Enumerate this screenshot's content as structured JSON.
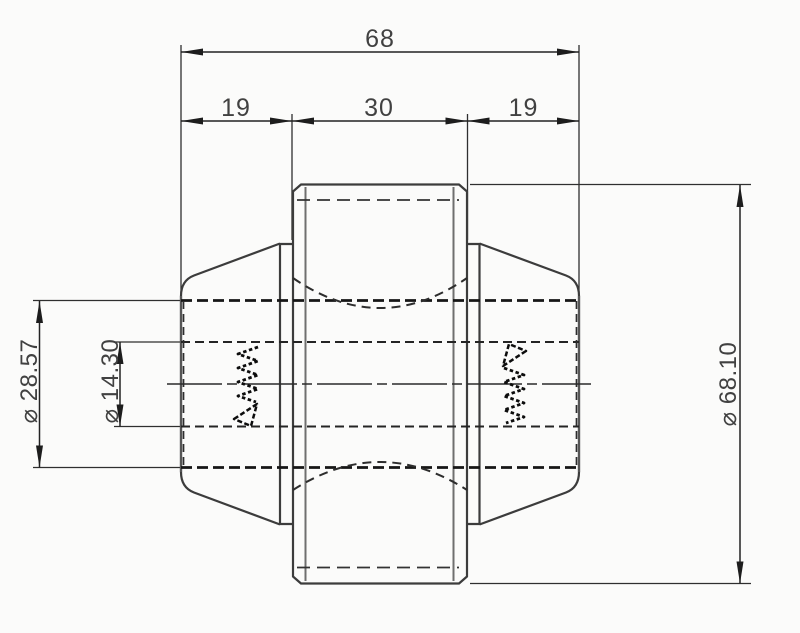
{
  "drawing": {
    "view": "section view",
    "dims": {
      "overall": {
        "label": "68",
        "value": 68
      },
      "left": {
        "label": "19",
        "value": 19
      },
      "center": {
        "label": "30",
        "value": 30
      },
      "right": {
        "label": "19",
        "value": 19
      },
      "hub": {
        "label": "⌀ 28.57",
        "value": 28.57
      },
      "bore": {
        "label": "⌀ 14.30",
        "value": 14.3
      },
      "od": {
        "label": "⌀ 68.10",
        "value": 68.1
      }
    },
    "colors": {
      "background": "#fbfbfa",
      "line": "#3c3c3c",
      "hidden_line": "#161616",
      "text": "#414141"
    }
  }
}
